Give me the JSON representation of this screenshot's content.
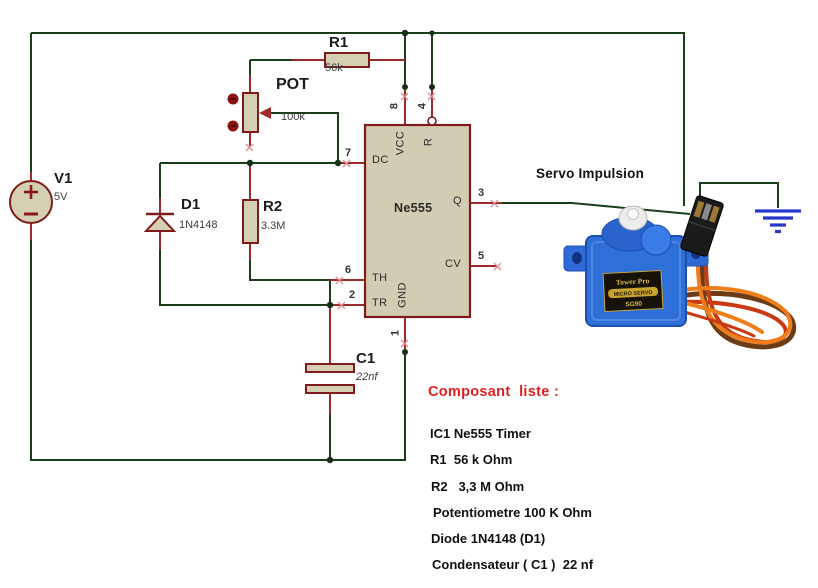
{
  "colors": {
    "wire_green": "#1a3f1a",
    "pin_red": "#9c2b2b",
    "component_outline": "#7e1a1a",
    "component_fill": "#d5cfb4",
    "ground_blue": "#2836c8",
    "list_title_red": "#e02020",
    "servo_blue": "#2f6fd8",
    "cable_orange": "#ef7d1a"
  },
  "components": {
    "v1": {
      "ref": "V1",
      "value": "5V"
    },
    "r1": {
      "ref": "R1",
      "value": "56k"
    },
    "pot": {
      "ref": "POT",
      "value": "100k"
    },
    "r2": {
      "ref": "R2",
      "value": "3.3M"
    },
    "d1": {
      "ref": "D1",
      "value": "1N4148"
    },
    "c1": {
      "ref": "C1",
      "value": "22nf"
    }
  },
  "ic": {
    "name": "Ne555",
    "pins": {
      "dc": "DC",
      "th": "TH",
      "tr": "TR",
      "q": "Q",
      "cv": "CV",
      "vcc": "VCC",
      "r": "R",
      "gnd": "GND"
    },
    "numbers": {
      "n7": "7",
      "n6": "6",
      "n2": "2",
      "n3": "3",
      "n5": "5",
      "n8": "8",
      "n4": "4",
      "n1": "1"
    }
  },
  "labels": {
    "output": "Servo Impulsion"
  },
  "servo": {
    "brand": "Tower Pro",
    "tag": "MICRO SERVO",
    "model": "SG90"
  },
  "component_list": {
    "title": "Composant  liste :",
    "items": [
      "IC1 Ne555 Timer",
      "R1  56 k Ohm",
      "R2   3,3 M Ohm",
      "Potentiometre 100 K Ohm",
      "Diode 1N4148 (D1)",
      "Condensateur ( C1 )  22 nf"
    ]
  }
}
